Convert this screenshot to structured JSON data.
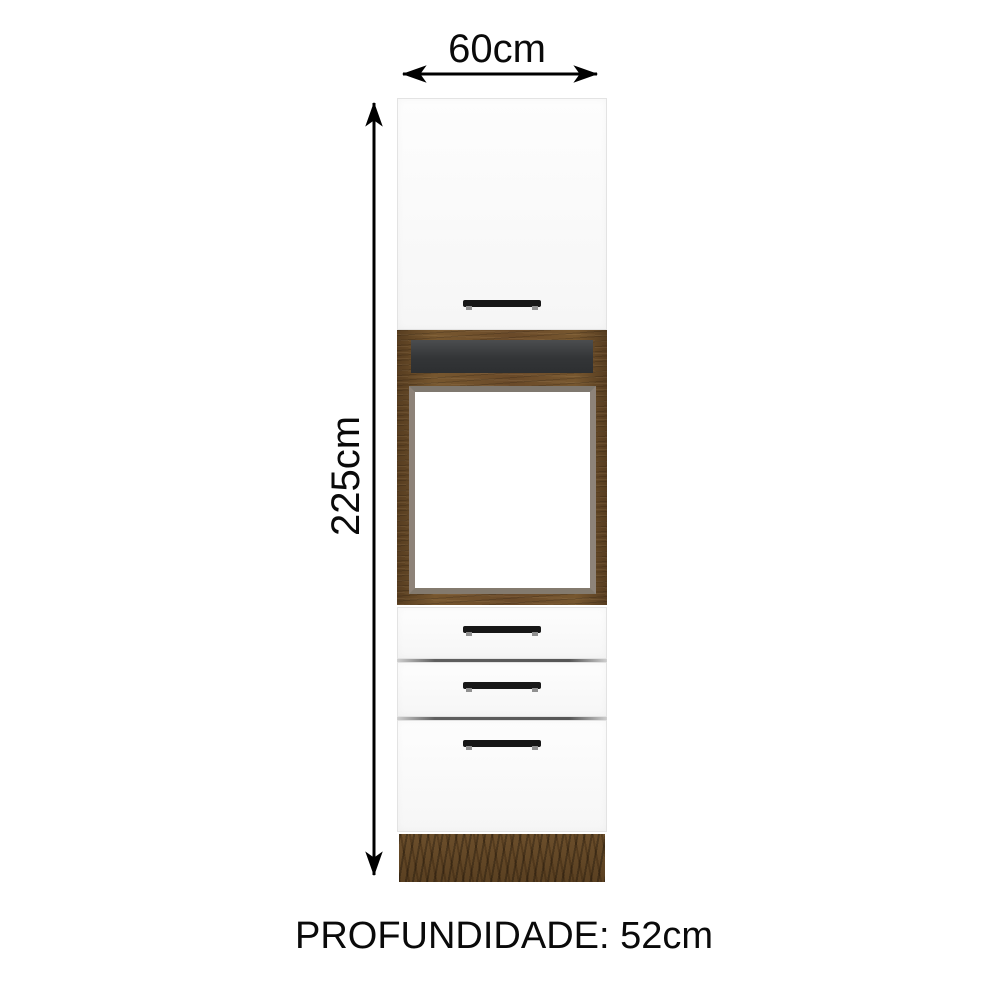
{
  "diagram": {
    "type": "furniture-dimension-diagram",
    "subject": "tall kitchen oven tower cabinet"
  },
  "labels": {
    "width": "60cm",
    "height": "225cm",
    "oven_height": "63cm",
    "depth": "PROFUNDIDADE: 52cm"
  },
  "cabinet": {
    "parts": [
      {
        "name": "upper-door",
        "finish": "white",
        "handle": "horizontal-black-bar"
      },
      {
        "name": "open-niche",
        "finish": "wood-frame-dark-back"
      },
      {
        "name": "oven-cavity",
        "finish": "wood-frame-white-interior"
      },
      {
        "name": "drawer-1",
        "finish": "white",
        "handle": "horizontal-black-bar"
      },
      {
        "name": "drawer-2",
        "finish": "white",
        "handle": "horizontal-black-bar"
      },
      {
        "name": "drawer-3",
        "finish": "white",
        "handle": "horizontal-black-bar"
      },
      {
        "name": "plinth",
        "finish": "wood"
      }
    ]
  },
  "colors": {
    "background": "#ffffff",
    "panel_white": "#fcfcfc",
    "panel_border": "#e3e3e3",
    "wood_brown": "#6b4c2d",
    "wood_dark": "#543a1e",
    "niche_back": "#3a3c3e",
    "cavity_lining": "#8e8379",
    "handle_black": "#171717",
    "dimension_black": "#0a0a0a"
  }
}
